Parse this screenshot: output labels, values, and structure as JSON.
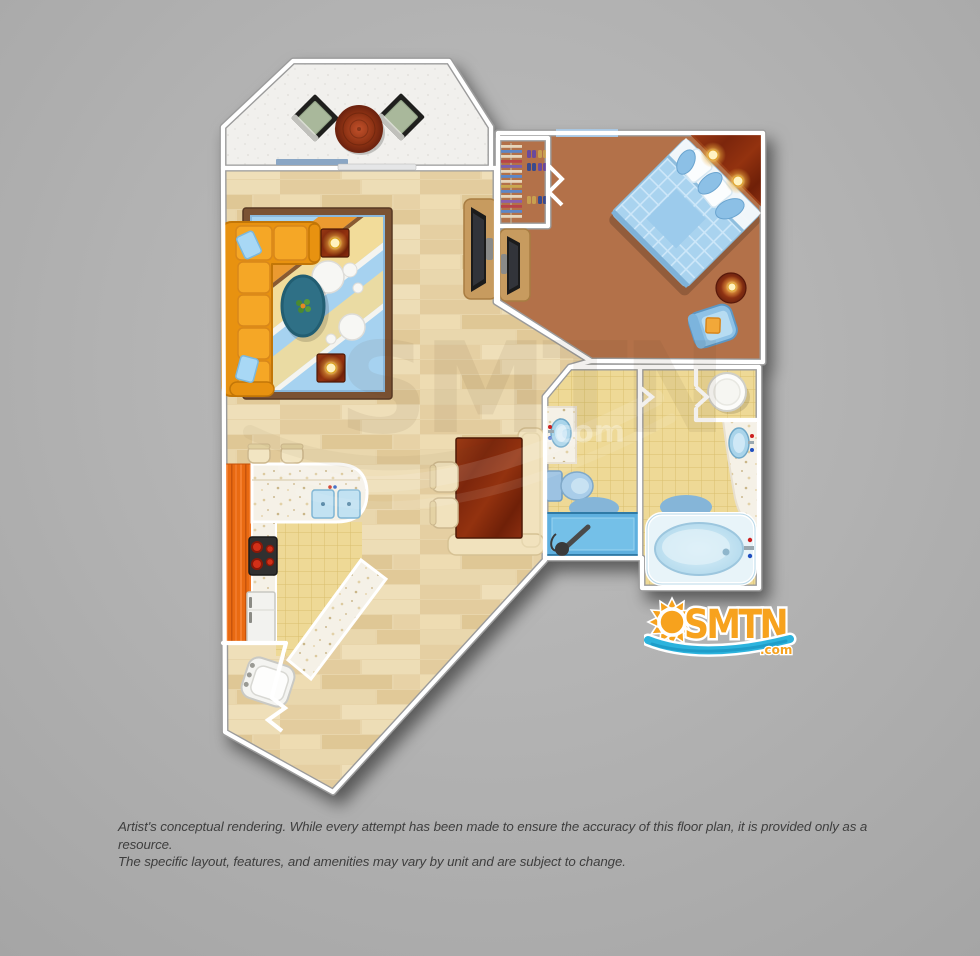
{
  "disclaimer": {
    "line1": "Artist's conceptual rendering. While every attempt has been made to ensure the accuracy of this floor plan, it is provided only as a resource.",
    "line2": "The specific layout, features, and amenities may vary by unit and are subject to change."
  },
  "logo": {
    "text": "SMTN",
    "domain": ".com",
    "colors": {
      "orange": "#f7a21d",
      "wave_blue": "#2cb3dd",
      "wave_dark_blue": "#1c97c4",
      "outline": "#ffffff"
    }
  },
  "watermark": {
    "text": "SMTN",
    "domain": ".com"
  },
  "floorplan": {
    "colors": {
      "background": "#b3b3b3",
      "wall": "#ffffff",
      "wood_floor": "#e8d5ab",
      "balcony_floor": "#f1f0ed",
      "bedroom_carpet": "#b3714a",
      "bathroom_tile": "#eed996",
      "counter_speckle": "#f5f1e7",
      "cabinet_orange": "#e96a12",
      "sofa_orange": "#f5a726",
      "rug_blue": "#a6d2f0",
      "bed_blue": "#a9d3ef",
      "tub_blue": "#cfe8f4",
      "table_wood_red": "#8a3012"
    },
    "rooms": [
      {
        "name": "balcony",
        "furniture": [
          "round-patio-table",
          "patio-chair",
          "patio-chair"
        ]
      },
      {
        "name": "living-room",
        "furniture": [
          "sectional-sofa",
          "area-rug",
          "coffee-table",
          "end-table-lamp",
          "end-table-lamp",
          "tv-console"
        ]
      },
      {
        "name": "bedroom",
        "furniture": [
          "bed",
          "corner-headboard",
          "lamp",
          "lamp",
          "closet",
          "tv-console",
          "armchair",
          "side-table-lamp",
          "window"
        ]
      },
      {
        "name": "bathroom-1",
        "furniture": [
          "vanity-sink",
          "toilet",
          "shower",
          "bath-mat"
        ]
      },
      {
        "name": "bathroom-2",
        "furniture": [
          "water-heater",
          "vanity-sink",
          "bathtub",
          "bath-mat"
        ]
      },
      {
        "name": "kitchen",
        "furniture": [
          "l-shaped-counter",
          "double-sink",
          "stove",
          "refrigerator",
          "bar-stool",
          "bar-stool",
          "peninsula-counter"
        ]
      },
      {
        "name": "dining-area",
        "furniture": [
          "dining-table",
          "corner-bench",
          "chair",
          "chair"
        ]
      },
      {
        "name": "foyer",
        "furniture": [
          "accent-chair",
          "entry-door"
        ]
      }
    ]
  }
}
